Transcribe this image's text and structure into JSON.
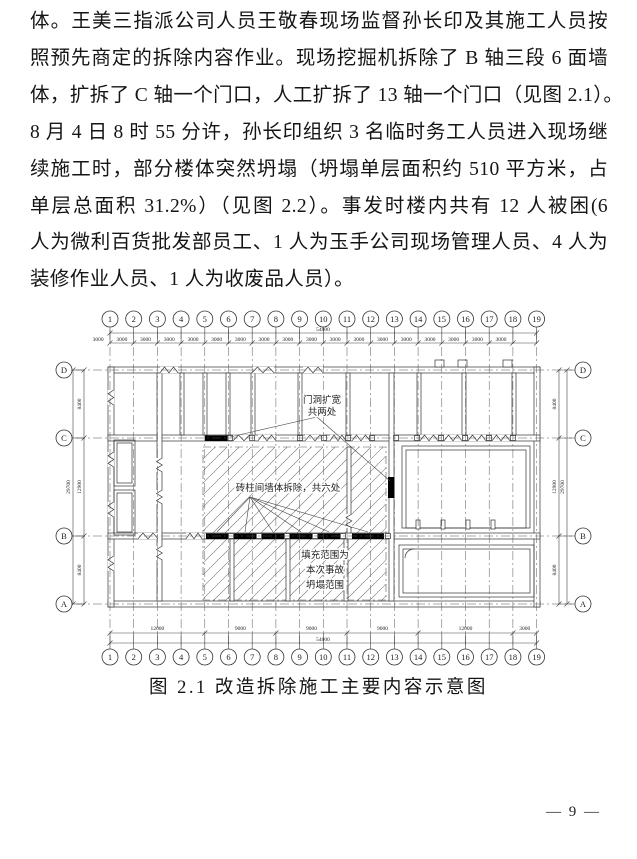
{
  "page": {
    "lines": [
      "体。王美三指派公司人员王敬春现场监督孙长印及其施工人员按",
      "照预先商定的拆除内容作业。现场挖掘机拆除了 B 轴三段 6 面墙",
      "体，扩拆了 C 轴一个门口，人工扩拆了 13 轴一个门口（见图 2.1）。",
      "8 月 4 日 8 时 55 分许，孙长印组织 3 名临时务工人员进入现场继",
      "续施工时，部分楼体突然坍塌（坍塌单层面积约 510 平方米，占",
      "单层总面积 31.2%）（见图 2.2）。事发时楼内共有 12 人被困(6",
      "人为微利百货批发部员工、1 人为玉手公司现场管理人员、4 人为",
      "装修作业人员、1 人为收废品人员）。"
    ],
    "page_number": "— 9 —"
  },
  "figure": {
    "caption": "图 2.1 改造拆除施工主要内容示意图",
    "grid": {
      "horizontal_axes": [
        "1",
        "2",
        "3",
        "4",
        "5",
        "6",
        "7",
        "8",
        "9",
        "10",
        "11",
        "12",
        "13",
        "14",
        "15",
        "16",
        "17",
        "18",
        "19"
      ],
      "vertical_axes": [
        "D",
        "C",
        "B",
        "A"
      ]
    },
    "dims": {
      "top_total": "54000",
      "top_segments": [
        "3000",
        "3000",
        "3000",
        "3000",
        "3000",
        "3000",
        "3000",
        "3000",
        "3000",
        "3000",
        "3000",
        "3000",
        "3000",
        "3000",
        "3000",
        "3000",
        "3000",
        "3000"
      ],
      "bottom_segments": [
        "12000",
        "9000",
        "9000",
        "9000",
        "12000",
        "3000"
      ],
      "bottom_total": "54000",
      "left_segments": [
        "8400",
        "12900",
        "8400"
      ],
      "left_total": "29700",
      "right_segments": [
        "8400",
        "12900",
        "8400"
      ],
      "right_total": "29700"
    },
    "annotations": {
      "door_widen": {
        "lines": [
          "门洞扩宽",
          "共两处"
        ]
      },
      "wall_demolish": {
        "lines": [
          "砖柱间墙体拆除，共六处"
        ]
      },
      "collapse_range": {
        "lines": [
          "填充范围为",
          "本次事故",
          "坍塌范围"
        ]
      }
    },
    "line_color": "#333333",
    "hatch_color": "#777777",
    "fill_black": "#000000"
  }
}
